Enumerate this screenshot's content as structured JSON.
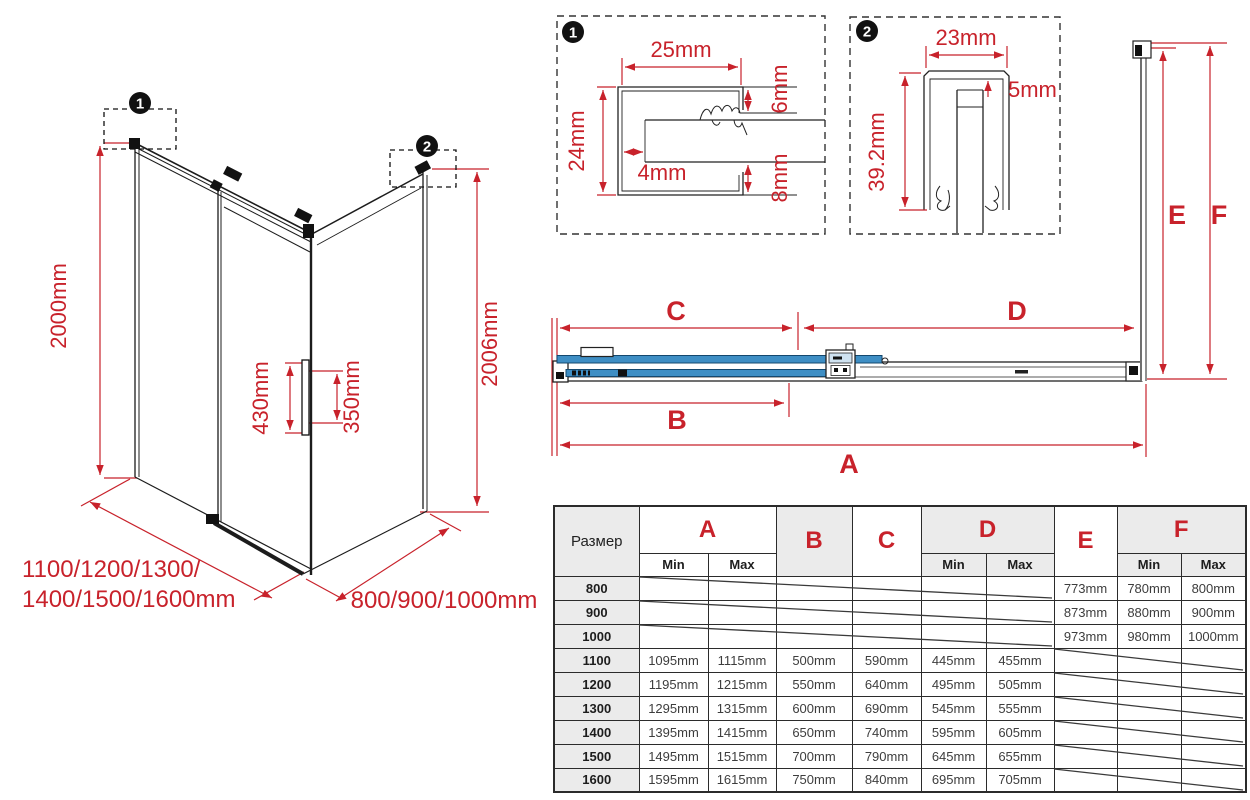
{
  "colors": {
    "red": "#c8222b",
    "blue": "#3e8ec4",
    "light_blue": "#cfe2f0",
    "line": "#222222"
  },
  "iso": {
    "badge1": "1",
    "badge2": "2",
    "height_left": "2000mm",
    "height_right": "2006mm",
    "handle_length": "430mm",
    "handle_centers": "350mm",
    "width_options_line1": "1100/1200/1300/",
    "width_options_line2": "1400/1500/1600mm",
    "depth_options": "800/900/1000mm"
  },
  "detail1": {
    "badge": "1",
    "top": "25mm",
    "left": "24mm",
    "gap": "4mm",
    "right_top": "6mm",
    "right_bottom": "8mm"
  },
  "detail2": {
    "badge": "2",
    "top": "23mm",
    "gap": "5mm",
    "left": "39.2mm"
  },
  "section": {
    "a": "A",
    "b": "B",
    "c": "C",
    "d": "D",
    "e": "E",
    "f": "F"
  },
  "table": {
    "size_header": "Размер",
    "min": "Min",
    "max": "Max",
    "cols": {
      "a": "A",
      "b": "B",
      "c": "C",
      "d": "D",
      "e": "E",
      "f": "F"
    },
    "rows": [
      {
        "size": "800",
        "a_min": "",
        "a_max": "",
        "b": "",
        "c": "",
        "d_min": "",
        "d_max": "",
        "e": "773mm",
        "f_min": "780mm",
        "f_max": "800mm"
      },
      {
        "size": "900",
        "a_min": "",
        "a_max": "",
        "b": "",
        "c": "",
        "d_min": "",
        "d_max": "",
        "e": "873mm",
        "f_min": "880mm",
        "f_max": "900mm"
      },
      {
        "size": "1000",
        "a_min": "",
        "a_max": "",
        "b": "",
        "c": "",
        "d_min": "",
        "d_max": "",
        "e": "973mm",
        "f_min": "980mm",
        "f_max": "1000mm"
      },
      {
        "size": "1100",
        "a_min": "1095mm",
        "a_max": "1115mm",
        "b": "500mm",
        "c": "590mm",
        "d_min": "445mm",
        "d_max": "455mm",
        "e": "",
        "f_min": "",
        "f_max": ""
      },
      {
        "size": "1200",
        "a_min": "1195mm",
        "a_max": "1215mm",
        "b": "550mm",
        "c": "640mm",
        "d_min": "495mm",
        "d_max": "505mm",
        "e": "",
        "f_min": "",
        "f_max": ""
      },
      {
        "size": "1300",
        "a_min": "1295mm",
        "a_max": "1315mm",
        "b": "600mm",
        "c": "690mm",
        "d_min": "545mm",
        "d_max": "555mm",
        "e": "",
        "f_min": "",
        "f_max": ""
      },
      {
        "size": "1400",
        "a_min": "1395mm",
        "a_max": "1415mm",
        "b": "650mm",
        "c": "740mm",
        "d_min": "595mm",
        "d_max": "605mm",
        "e": "",
        "f_min": "",
        "f_max": ""
      },
      {
        "size": "1500",
        "a_min": "1495mm",
        "a_max": "1515mm",
        "b": "700mm",
        "c": "790mm",
        "d_min": "645mm",
        "d_max": "655mm",
        "e": "",
        "f_min": "",
        "f_max": ""
      },
      {
        "size": "1600",
        "a_min": "1595mm",
        "a_max": "1615mm",
        "b": "750mm",
        "c": "840mm",
        "d_min": "695mm",
        "d_max": "705mm",
        "e": "",
        "f_min": "",
        "f_max": ""
      }
    ]
  }
}
